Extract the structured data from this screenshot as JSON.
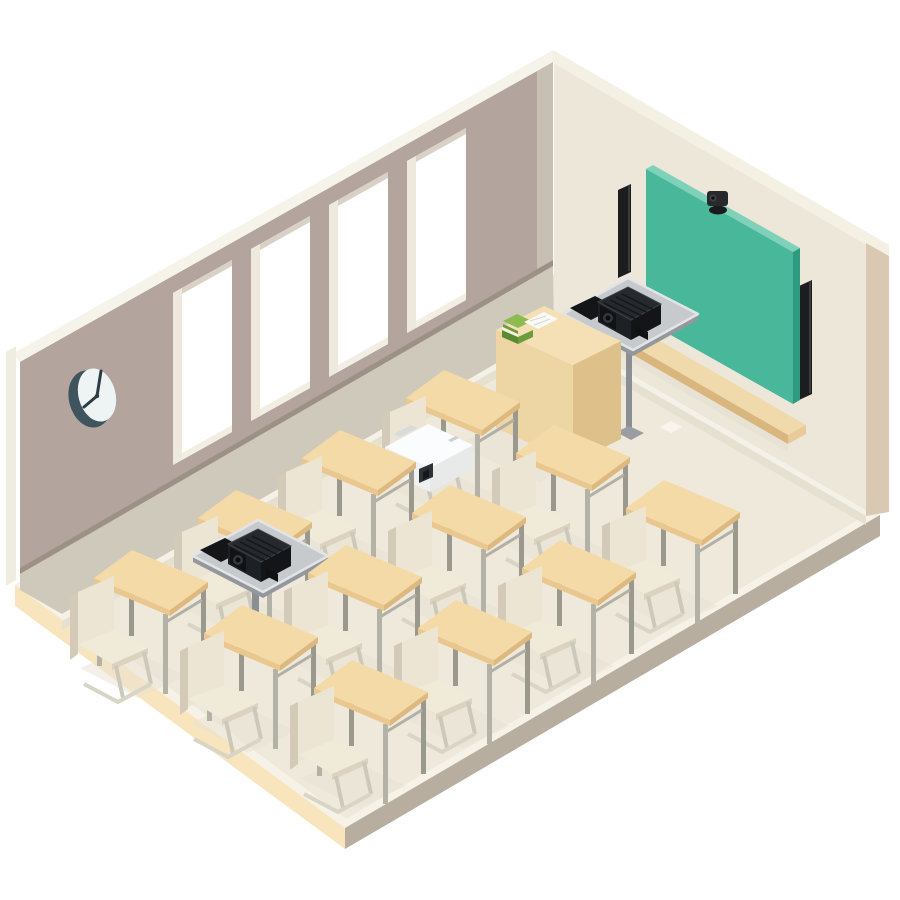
{
  "title": "Isometric classroom illustration with classroom AV setup",
  "palette": {
    "background": "#ffffff",
    "left_wall": "#b3a59e",
    "left_wall_top": "#f6f3ea",
    "left_wall_sill": "#9d9085",
    "left_wall_lower": "#cfc9bb",
    "left_wall_cut": "#efece2",
    "corner_strip": "#c6bfb2",
    "right_wall": "#ece7d9",
    "right_wall_top": "#f4f0e3",
    "right_wall_edge": "#d9c9b3",
    "baseboard": "#f4f1e8",
    "wall_floor_shadow": "#e6e0d1",
    "floor": "#efe9dc",
    "floor_highlight": "#f6f2e7",
    "slab_left": "#f9e5bd",
    "slab_right": "#b8aea0",
    "window_white": "#ffffff",
    "window_reveal": "#efe9dd",
    "window_sill": "#f3eee3",
    "window_top_reveal": "#d9d1c5",
    "clock_rim": "#3f545c",
    "clock_face": "#eef3f4",
    "clock_hands": "#2b3d44",
    "board": "#48b79a",
    "board_edge": "#2e9b80",
    "board_top": "#7fd2b9",
    "tray_top": "#f0d9ab",
    "tray_front": "#d8b67e",
    "tray_end": "#e8cb97",
    "speaker": "#1c1d1f",
    "speaker_highlight": "#3a3b3f",
    "camera_body": "#27292d",
    "camera_dark": "#1a1b1d",
    "camera_lens": "#3c4147",
    "platform_top": "#c7cacd",
    "platform_rim": "#e2e4e6",
    "platform_under": "#94989c",
    "pole": "#8b8f93",
    "pole_base": "#9a9ea2",
    "mat_black": "#141517",
    "black_projector_top": "#26292d",
    "black_projector_left": "#1d2024",
    "black_projector_right": "#131518",
    "black_projector_lens_plate": "#101214",
    "black_projector_lens": "#34383e",
    "black_projector_lens_core": "#0b0c0e",
    "black_projector_vent": "#15171a",
    "black_projector_outline": "#3e4247",
    "white_projector_top": "#fbfcfd",
    "white_projector_left": "#eff1f0",
    "white_projector_right": "#e7eae9",
    "white_projector_lens": "#2e3237",
    "white_projector_lens_core": "#15181c",
    "white_projector_label": "#d9dbda",
    "white_projector_ports": "#3c4146",
    "desk_top": "#f4daa6",
    "desk_edge_left": "#e9c78f",
    "desk_edge_right": "#ddb97f",
    "desk_leg": "#b4b1a7",
    "desk_leg_dark": "#9b988e",
    "desk_rail": "#b2afa5",
    "chair_back": "#ece5d4",
    "chair_back_side": "#d3cbb7",
    "chair_seat": "#f0ead9",
    "chair_seat_edge": "#dbd3bf",
    "chair_tube": "#ccc8ba",
    "chair_runner": "#d8d4c6",
    "teacher_desk_top": "#f4e0b4",
    "teacher_desk_left": "#eed5a4",
    "teacher_desk_right": "#dec08a",
    "book_green_top": "#8dbb51",
    "book_green_side": "#6d9c3c",
    "book_green_dark": "#5c8a31",
    "paper": "#f9f9f5",
    "shadow": "#e7e1d3"
  },
  "objects": {
    "room": {
      "walls": [
        "left wall with windows",
        "right wall with chalkboard"
      ],
      "floor": "cream floor slab on white background"
    },
    "clock": {
      "position": [
        93,
        397
      ],
      "style": "wall clock, dark rim, plain face"
    },
    "windows": {
      "count": 4,
      "first_window_left_x": 173,
      "step": [
        78,
        -44
      ]
    },
    "chalkboard": {
      "color": "teal green",
      "position": "right wall"
    },
    "camera_on_board": {
      "type": "small PTZ camera on top edge of chalkboard",
      "position": [
        711,
        192
      ]
    },
    "speakers": {
      "count": 2,
      "type": "slim black vertical wall speakers flanking the board"
    },
    "chalk_tray": {
      "material": "wood",
      "below": "chalkboard"
    },
    "teacher_desk": {
      "position": [
        496,
        306
      ],
      "items_on_top": [
        "green books stack",
        "white papers"
      ]
    },
    "projector_stands": {
      "count": 2,
      "description": "gray square platforms each holding a black projector and a black tablet mat",
      "wall_mounted_T": [
        628,
        278
      ],
      "floor_mounted_T": [
        258,
        520
      ]
    },
    "white_projector_on_desk": {
      "position": [
        385,
        424
      ],
      "desk": [
        444,
        370
      ]
    },
    "student_desks": {
      "count": 12,
      "projector_desk": [
        444,
        370
      ],
      "group_back": [
        [
          340,
          430
        ],
        [
          554,
          425
        ],
        [
          664,
          480
        ],
        [
          236,
          490
        ],
        [
          450,
          485
        ]
      ],
      "group_front": [
        [
          560,
          540
        ],
        [
          346,
          545
        ],
        [
          132,
          550
        ],
        [
          456,
          600
        ],
        [
          242,
          605
        ],
        [
          352,
          660
        ]
      ]
    },
    "chairs": {
      "count": 12,
      "style": "cantilever chairs facing the chalkboard"
    },
    "floor_paper": {
      "position": [
        660,
        427
      ]
    }
  }
}
